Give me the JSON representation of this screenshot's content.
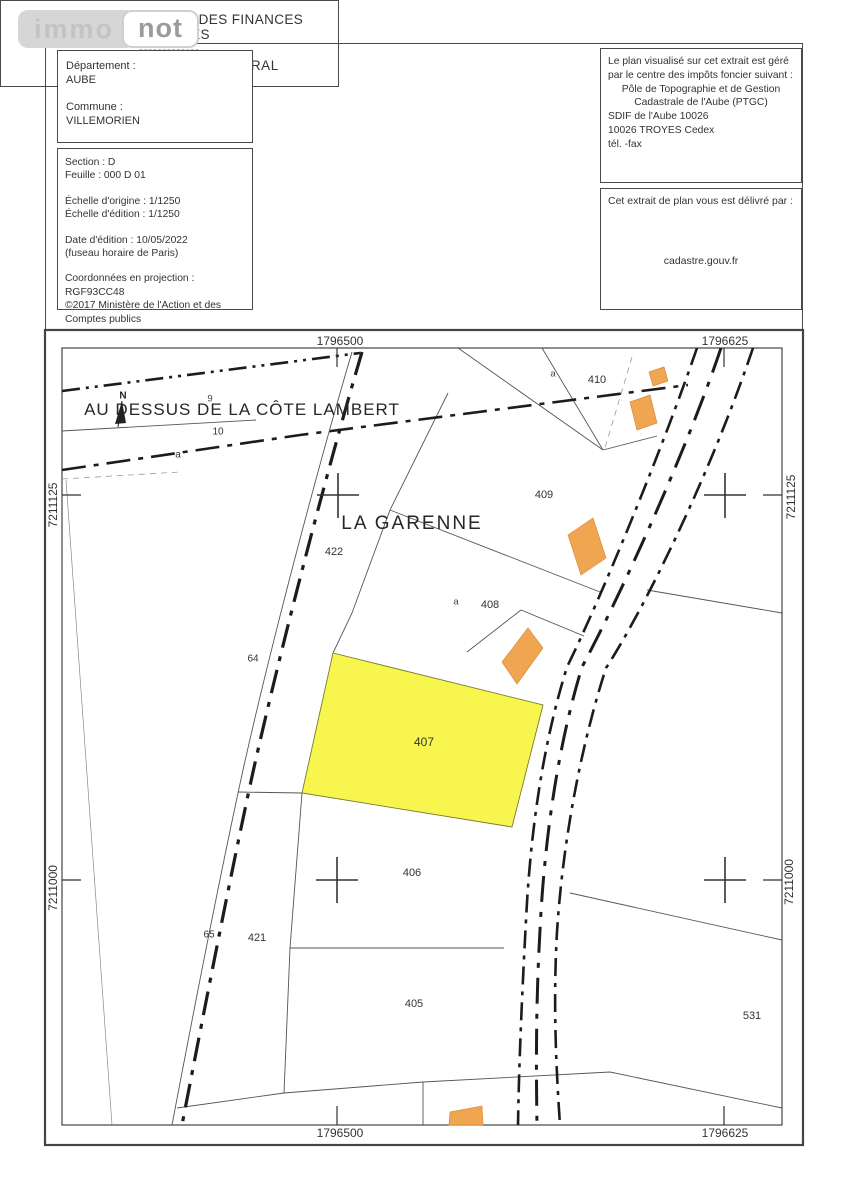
{
  "logo": {
    "left": "immo",
    "right": "not"
  },
  "header": {
    "left_box": {
      "departement_label": "Département :",
      "departement": "AUBE",
      "commune_label": "Commune :",
      "commune": "VILLEMORIEN"
    },
    "info_box": {
      "section": "Section : D",
      "feuille": "Feuille : 000 D 01",
      "echelle_origine": "Échelle d'origine : 1/1250",
      "echelle_edition": "Échelle d'édition : 1/1250",
      "date_edition": "Date d'édition : 10/05/2022",
      "fuseau": "(fuseau horaire de Paris)",
      "projection": "Coordonnées en projection : RGF93CC48",
      "copyright1": "©2017 Ministère de l'Action et des",
      "copyright2": "Comptes publics"
    },
    "title_box": {
      "line1": "DIRECTION GÉNÉRALE DES FINANCES PUBLIQUES",
      "sep1": "-------------",
      "line2": "EXTRAIT DU PLAN CADASTRAL",
      "sep2": "-------------"
    },
    "manager_box": {
      "l1": "Le plan visualisé sur cet extrait est géré",
      "l2": "par le centre des impôts foncier suivant :",
      "l3": "Pôle de Topographie et de Gestion",
      "l4": "Cadastrale de l'Aube (PTGC)",
      "l5": "SDIF de l'Aube 10026",
      "l6": "10026  TROYES Cedex",
      "l7": "tél.  -fax"
    },
    "delivery_box": {
      "label": "Cet extrait de plan vous est délivré par :",
      "value": "cadastre.gouv.fr"
    }
  },
  "map": {
    "highlight_color": "#f8f545",
    "building_color": "#f0a551",
    "labels": [
      {
        "id": "grid-top-left",
        "text": "1796500"
      },
      {
        "id": "grid-top-right",
        "text": "1796625"
      },
      {
        "id": "grid-bottom-left",
        "text": "1796500"
      },
      {
        "id": "grid-bottom-right",
        "text": "1796625"
      },
      {
        "id": "grid-left-upper",
        "text": "7211125"
      },
      {
        "id": "grid-left-lower",
        "text": "7211000"
      },
      {
        "id": "grid-right-upper",
        "text": "7211125"
      },
      {
        "id": "grid-right-lower",
        "text": "7211000"
      },
      {
        "id": "place-name-1",
        "text": "AU DESSUS DE LA CÔTE LAMBERT"
      },
      {
        "id": "north-letter",
        "text": "N"
      },
      {
        "id": "parcel-9",
        "text": "9"
      },
      {
        "id": "parcel-10",
        "text": "10"
      },
      {
        "id": "subdivision-a-left",
        "text": "a"
      },
      {
        "id": "place-name-2",
        "text": "LA GARENNE"
      },
      {
        "id": "parcel-422",
        "text": "422"
      },
      {
        "id": "parcel-409",
        "text": "409"
      },
      {
        "id": "subdivision-a-410",
        "text": "a"
      },
      {
        "id": "parcel-410",
        "text": "410"
      },
      {
        "id": "subdivision-a-408",
        "text": "a"
      },
      {
        "id": "parcel-408",
        "text": "408"
      },
      {
        "id": "parcel-407",
        "text": "407"
      },
      {
        "id": "parcel-406",
        "text": "406"
      },
      {
        "id": "parcel-64",
        "text": "64"
      },
      {
        "id": "parcel-65",
        "text": "65"
      },
      {
        "id": "parcel-421",
        "text": "421"
      },
      {
        "id": "parcel-405",
        "text": "405"
      },
      {
        "id": "parcel-531",
        "text": "531"
      }
    ]
  }
}
